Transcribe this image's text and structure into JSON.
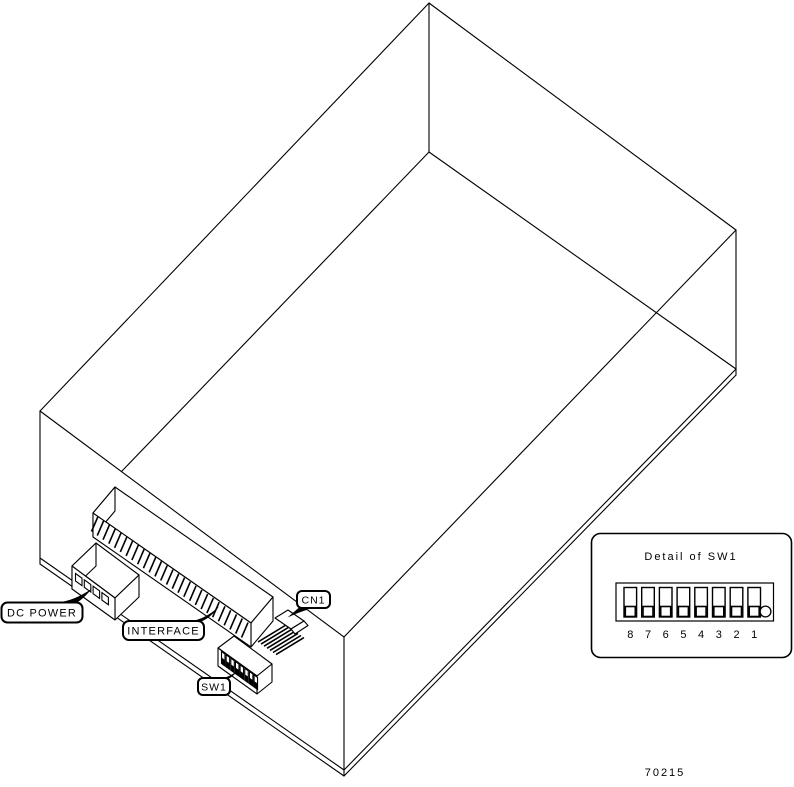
{
  "drawing": {
    "background_color": "#ffffff",
    "line_color": "#000000"
  },
  "callouts": {
    "dc_power": {
      "label": "DC POWER"
    },
    "interface": {
      "label": "INTERFACE"
    },
    "cn1": {
      "label": "CN1"
    },
    "sw1": {
      "label": "SW1"
    }
  },
  "detail_panel": {
    "title": "Detail of SW1",
    "switch_numbers": [
      "8",
      "7",
      "6",
      "5",
      "4",
      "3",
      "2",
      "1"
    ]
  },
  "part_number": "70215"
}
